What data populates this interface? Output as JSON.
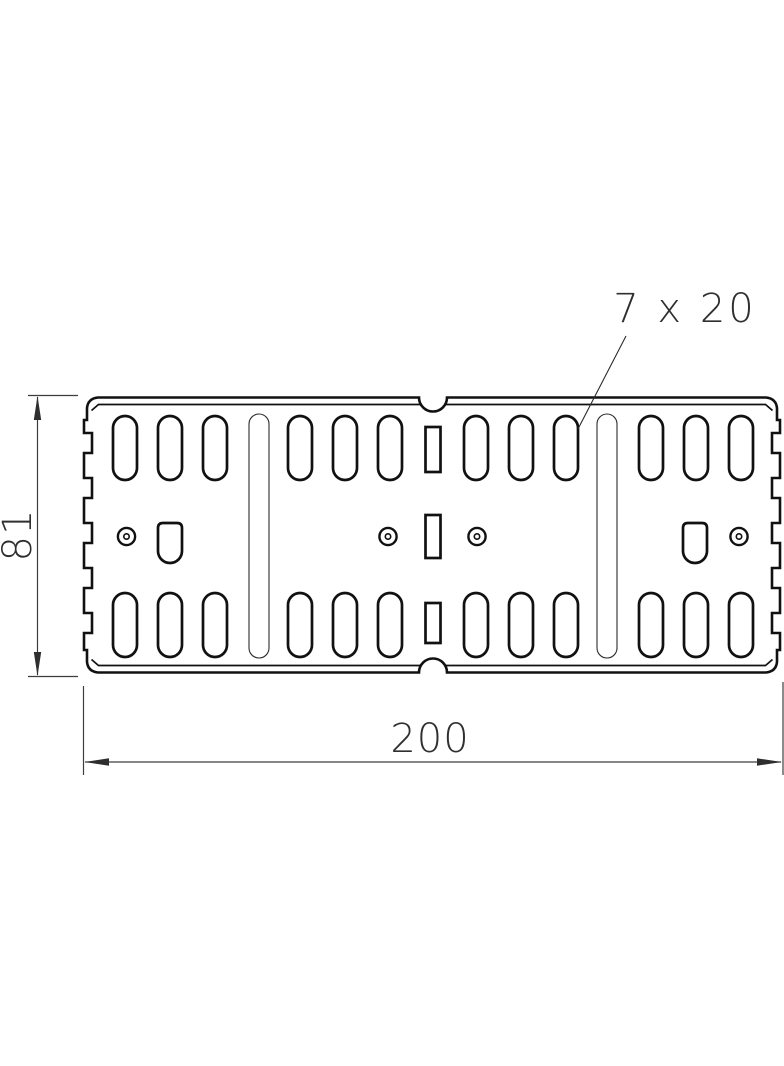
{
  "annotations": {
    "slot_size_label": "7 x 20",
    "height_dimension": "81",
    "width_dimension": "200"
  },
  "drawing": {
    "type": "technical-drawing-plate-view",
    "features": {
      "oblong_slots_top_row": 12,
      "oblong_slots_bottom_row": 12,
      "long_vertical_slots": 2,
      "round_holes_with_center": 4,
      "d_shaped_holes": 2,
      "small_rectangular_slots": 3,
      "edge_notches_per_side": 5,
      "half_round_edge_notches": 2
    },
    "colors": {
      "line": "#111111",
      "dimension_line": "#3d3d3d",
      "background": "#ffffff"
    }
  }
}
